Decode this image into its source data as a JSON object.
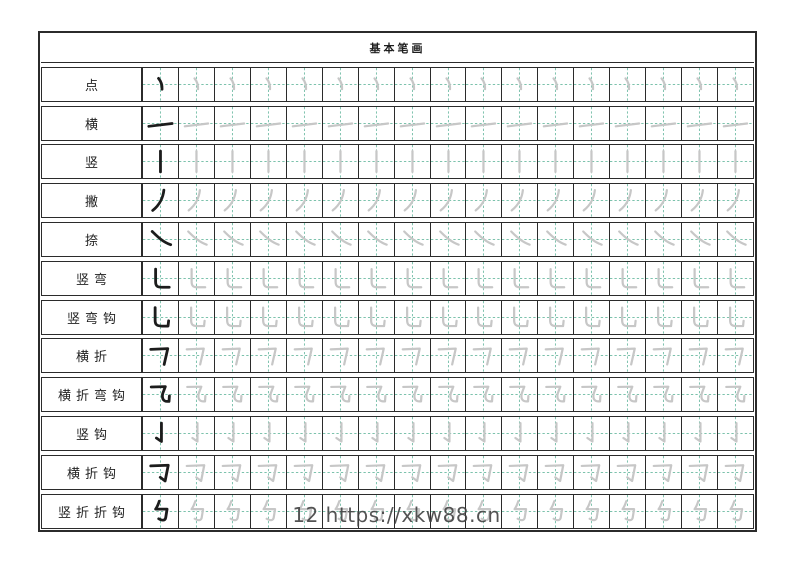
{
  "page": {
    "title": "基本笔画",
    "footer": "12 https://xkw88.cn"
  },
  "colors": {
    "guide_line": "#7cc2ac",
    "example_stroke": "#1c1c1c",
    "trace_stroke": "#c7c7c7",
    "border": "#2b2b2b"
  },
  "grid": {
    "cells_per_row": 17,
    "example_cells": 1,
    "trace_cells": 16
  },
  "rows": [
    {
      "label": "点",
      "stroke": "dian"
    },
    {
      "label": "横",
      "stroke": "heng"
    },
    {
      "label": "竖",
      "stroke": "shu"
    },
    {
      "label": "撇",
      "stroke": "pie"
    },
    {
      "label": "捺",
      "stroke": "na"
    },
    {
      "label": "竖弯",
      "stroke": "shu-wan"
    },
    {
      "label": "竖弯钩",
      "stroke": "shu-wan-gou"
    },
    {
      "label": "横折",
      "stroke": "heng-zhe"
    },
    {
      "label": "横折弯钩",
      "stroke": "heng-zhe-wan-gou"
    },
    {
      "label": "竖钩",
      "stroke": "shu-gou"
    },
    {
      "label": "横折钩",
      "stroke": "heng-zhe-gou"
    },
    {
      "label": "竖折折钩",
      "stroke": "shu-zhe-zhe-gou"
    }
  ]
}
